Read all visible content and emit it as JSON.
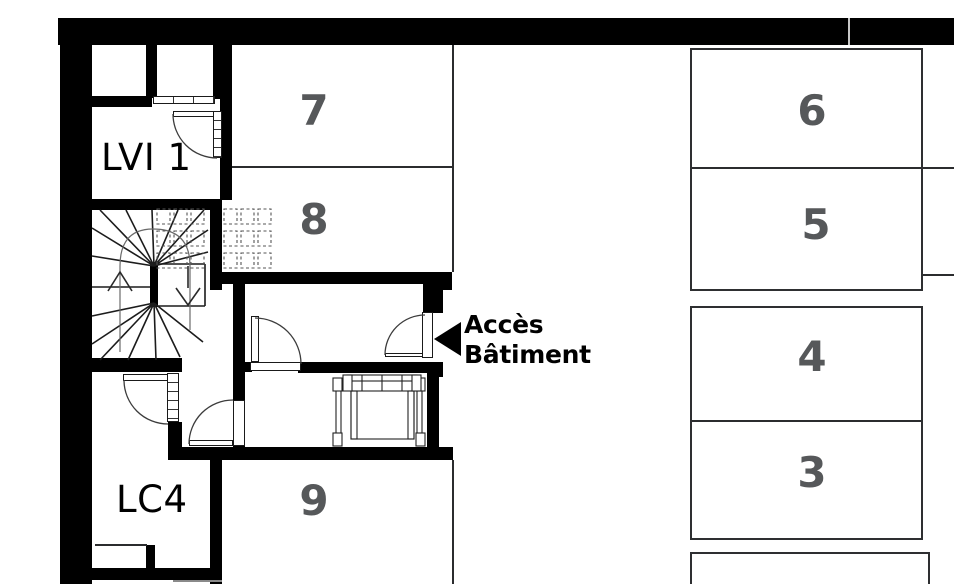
{
  "colors": {
    "wall": "#000000",
    "parking_number": "#56585a",
    "thin_line": "#2b2c2e"
  },
  "rooms": {
    "lvi1": {
      "label": "LVI 1"
    },
    "lc4": {
      "label": "LC4"
    }
  },
  "access": {
    "line1": "Accès",
    "line2": "Bâtiment"
  },
  "parking": {
    "spaces": [
      {
        "number": "7"
      },
      {
        "number": "8"
      },
      {
        "number": "9"
      },
      {
        "number": "6"
      },
      {
        "number": "5"
      },
      {
        "number": "4"
      },
      {
        "number": "3"
      }
    ]
  }
}
